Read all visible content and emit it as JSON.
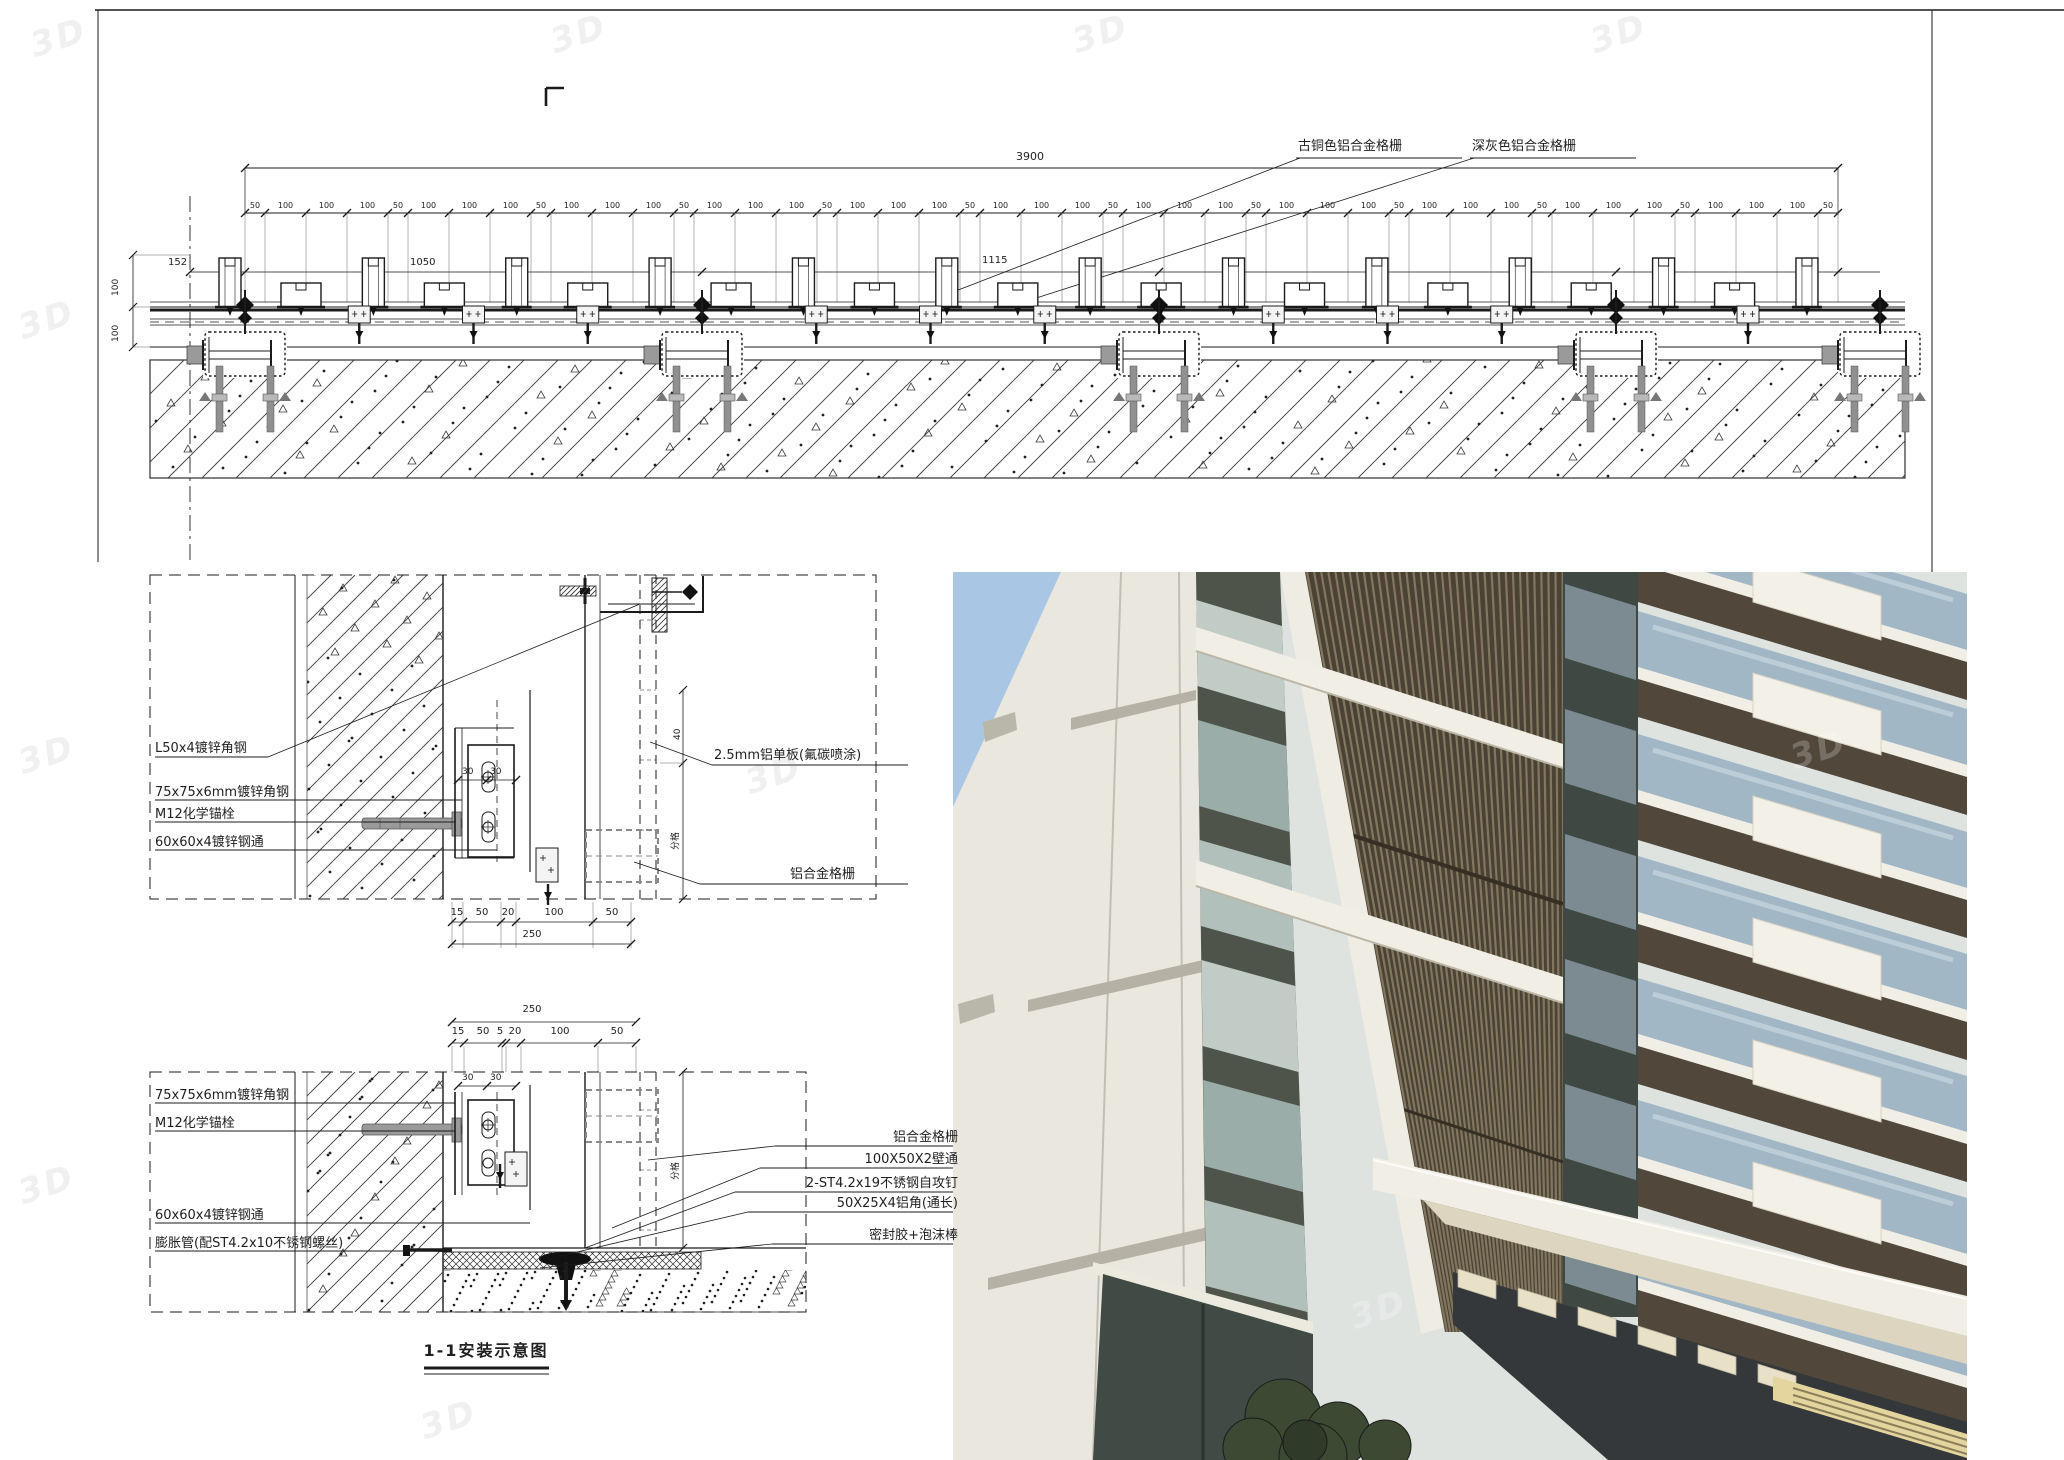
{
  "sheet": {
    "background": "#ffffff",
    "line_color": "#1b1b1b",
    "watermark_text": "3D"
  },
  "top_drawing": {
    "label_bronze": "古铜色铝合金格栅",
    "label_gray": "深灰色铝合金格栅",
    "overall_dim": "3900",
    "dim_pattern": [
      "50",
      "100",
      "100",
      "100"
    ],
    "dim_repeats": 11,
    "dim_tail": "50",
    "dim_152": "152",
    "dim_1050": "1050",
    "dim_1115": "1115",
    "left_vertical_dims": [
      "100",
      "100"
    ]
  },
  "detail_top": {
    "labels_left": [
      "L50x4镀锌角钢",
      "75x75x6mm镀锌角钢",
      "M12化学锚栓",
      "60x60x4镀锌钢通"
    ],
    "label_panel": "2.5mm铝单板(氟碳喷涂)",
    "label_grille": "铝合金格栅",
    "dims_bottom": [
      "15",
      "50",
      "20",
      "100",
      "50"
    ],
    "dims_bottom_total": "250",
    "dims_inner": [
      "30",
      "30"
    ],
    "dim_vertical_top": "40",
    "dim_vertical_module": "分格"
  },
  "detail_bottom": {
    "dims_top": [
      "15",
      "50",
      "5",
      "20",
      "100",
      "50"
    ],
    "dims_top_total": "250",
    "dims_inner": [
      "30",
      "30"
    ],
    "labels_left": [
      "75x75x6mm镀锌角钢",
      "M12化学锚栓",
      "60x60x4镀锌钢通",
      "膨胀管(配ST4.2x10不锈钢螺丝)"
    ],
    "labels_right": [
      "铝合金格栅",
      "100X50X2壁通",
      "2-ST4.2x19不锈钢自攻钉",
      "50X25X4铝角(通长)",
      "密封胶+泡沫棒"
    ],
    "dim_vertical_module": "分格",
    "caption": "1-1安装示意图"
  },
  "photo": {
    "colors": {
      "sky": "#a9c7e5",
      "wall": "#eae7de",
      "wall_joint": "#c2beb1",
      "wall_band": "#b5b1a4",
      "mullion": "#4f544a",
      "glass": "#c7d3ce",
      "louver_base": "#4a4335",
      "louver_stripe": "#8d7f66",
      "fascia": "#f1eee5",
      "fascia_underside": "#ddd5c0",
      "balcony_glass": "#a2b7c6",
      "bronze_band": "#51473a",
      "dark_soffit": "#34383a",
      "lit_ceiling": "#e4d59e",
      "tree": "#3c4a34"
    }
  }
}
